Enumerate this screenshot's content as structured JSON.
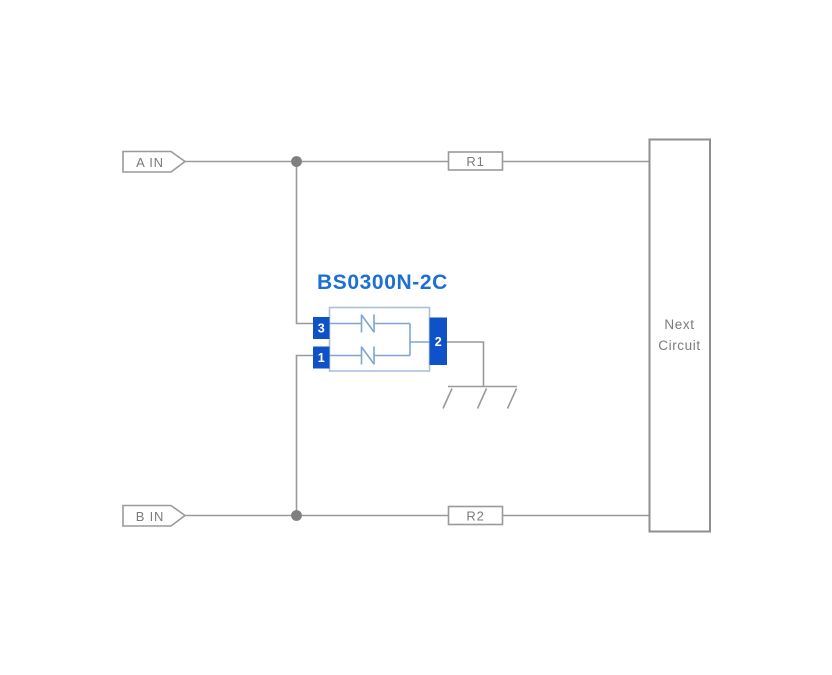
{
  "page": {
    "background": "#ffffff"
  },
  "inputs": [
    {
      "label": "A IN"
    },
    {
      "label": "B IN"
    }
  ],
  "resistors": [
    {
      "label": "R1"
    },
    {
      "label": "R2"
    }
  ],
  "component": {
    "title": "BS0300N-2C",
    "pins": [
      {
        "number": "3"
      },
      {
        "number": "1"
      },
      {
        "number": "2"
      }
    ]
  },
  "next_circuit": {
    "label": "Next Circuit"
  },
  "ground": {
    "type": "chassis-ground"
  },
  "colors": {
    "wire": "#9a9a9a",
    "label_text": "#7b7b7b",
    "component_title": "#1d6fd6",
    "pin_fill": "#0f52c7",
    "component_border": "#a6c1dd",
    "inner_wire": "#7fa6d2",
    "junction_dot": "#7f7f7f"
  }
}
